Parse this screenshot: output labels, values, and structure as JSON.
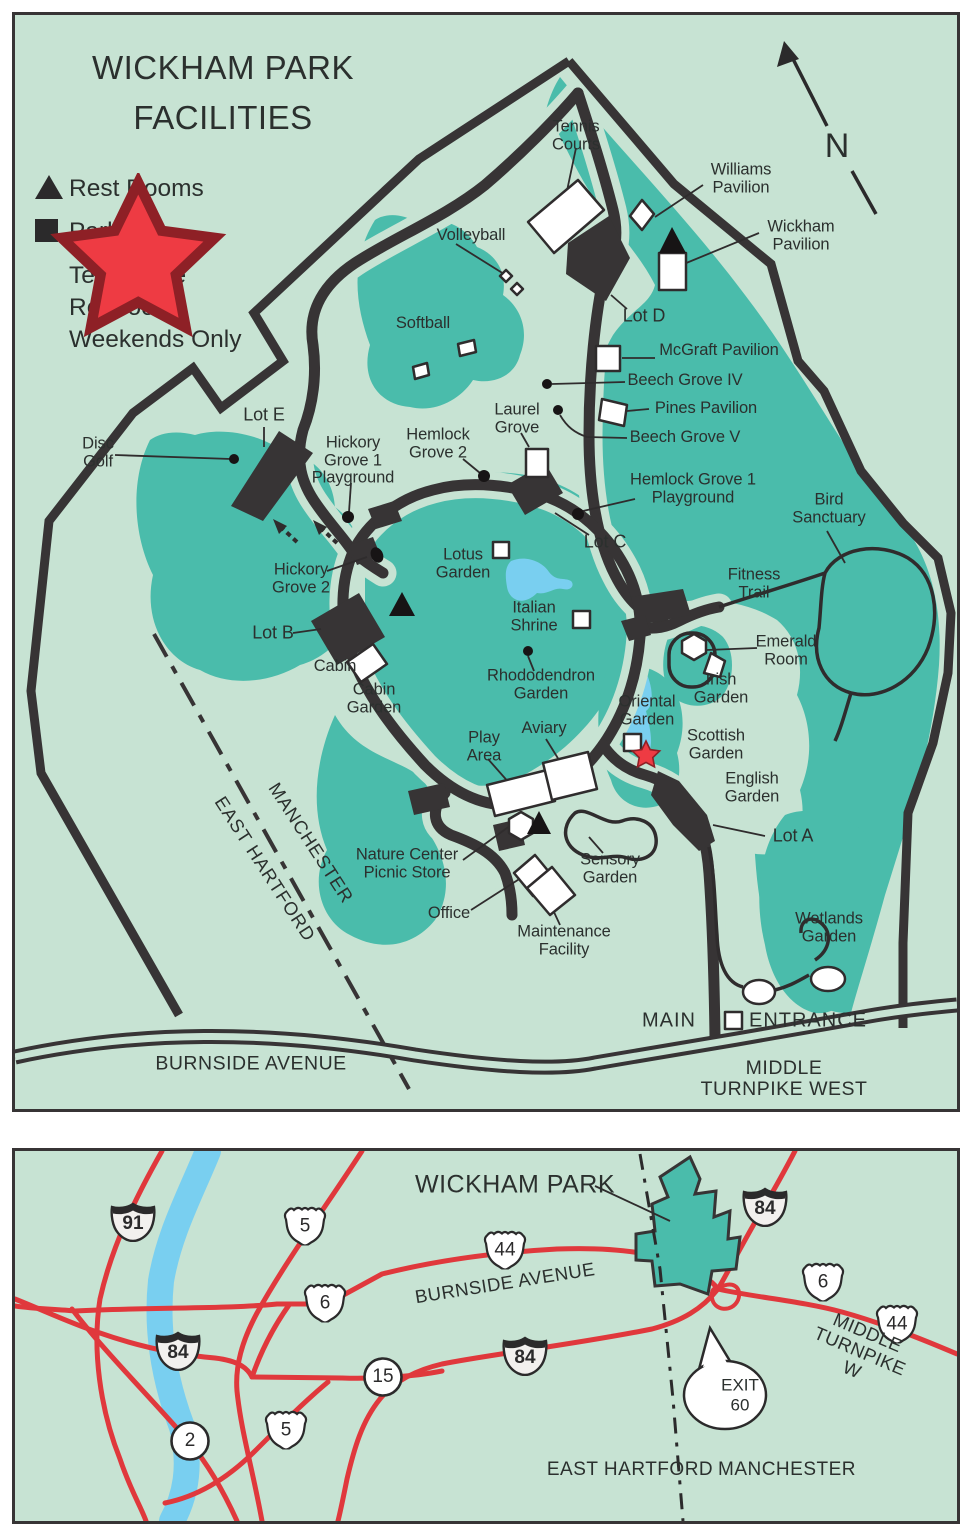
{
  "colors": {
    "background_mint": "#c7e3d3",
    "wooded_teal": "#4abcab",
    "road_dark": "#373435",
    "text_dark": "#2b302e",
    "highway_red": "#e0383c",
    "water_blue": "#79cff0",
    "star_red": "#ee3b43"
  },
  "facilities_map": {
    "title_line1": "WICKHAM PARK",
    "title_line2": "FACILITIES",
    "legend": {
      "restrooms": "Rest Rooms",
      "parking": "Parking",
      "tea_house": "Tea House\nRestroom\nWeekends Only"
    },
    "north_letter": "N",
    "labels": [
      {
        "id": "north-letter",
        "t": "N",
        "x": 822,
        "y": 131,
        "fs": 34
      },
      {
        "id": "tennis-courts",
        "t": "Tennis\nCourts",
        "x": 561,
        "y": 121
      },
      {
        "id": "williams-pavilion",
        "t": "Williams\nPavilion",
        "x": 726,
        "y": 164
      },
      {
        "id": "wickham-pavilion",
        "t": "Wickham\nPavilion",
        "x": 786,
        "y": 221
      },
      {
        "id": "volleyball",
        "t": "Volleyball",
        "x": 456,
        "y": 221
      },
      {
        "id": "softball",
        "t": "Softball",
        "x": 408,
        "y": 309
      },
      {
        "id": "lot-d",
        "t": "Lot D",
        "x": 629,
        "y": 301,
        "fs": 18
      },
      {
        "id": "mcgraft-pavilion",
        "t": "McGraft Pavilion",
        "x": 704,
        "y": 336
      },
      {
        "id": "beech-grove-iv",
        "t": "Beech Grove IV",
        "x": 670,
        "y": 366
      },
      {
        "id": "pines-pavilion",
        "t": "Pines Pavilion",
        "x": 691,
        "y": 394
      },
      {
        "id": "beech-grove-v",
        "t": "Beech Grove V",
        "x": 670,
        "y": 423
      },
      {
        "id": "laurel-grove",
        "t": "Laurel\nGrove",
        "x": 502,
        "y": 404
      },
      {
        "id": "hemlock-grove-2",
        "t": "Hemlock\nGrove 2",
        "x": 423,
        "y": 429
      },
      {
        "id": "hemlock-grove-1-playground",
        "t": "Hemlock Grove 1\nPlayground",
        "x": 678,
        "y": 474
      },
      {
        "id": "lot-c",
        "t": "Lot C",
        "x": 590,
        "y": 527,
        "fs": 18
      },
      {
        "id": "bird-sanctuary",
        "t": "Bird\nSanctuary",
        "x": 814,
        "y": 494
      },
      {
        "id": "lot-e",
        "t": "Lot E",
        "x": 249,
        "y": 400,
        "fs": 18
      },
      {
        "id": "disc-golf",
        "t": "Disc\nGolf",
        "x": 83,
        "y": 438
      },
      {
        "id": "hickory-grove-1-playground",
        "t": "Hickory\nGrove 1\nPlayground",
        "x": 338,
        "y": 446
      },
      {
        "id": "hickory-grove-2",
        "t": "Hickory\nGrove 2",
        "x": 286,
        "y": 564
      },
      {
        "id": "lotus-garden",
        "t": "Lotus\nGarden",
        "x": 448,
        "y": 549
      },
      {
        "id": "fitness-trail",
        "t": "Fitness\nTrail",
        "x": 739,
        "y": 569
      },
      {
        "id": "italian-shrine",
        "t": "Italian\nShrine",
        "x": 519,
        "y": 602
      },
      {
        "id": "emerald-room",
        "t": "Emerald\nRoom",
        "x": 771,
        "y": 636
      },
      {
        "id": "lot-b",
        "t": "Lot B",
        "x": 258,
        "y": 618,
        "fs": 18
      },
      {
        "id": "cabin",
        "t": "Cabin",
        "x": 320,
        "y": 652
      },
      {
        "id": "cabin-garden",
        "t": "Cabin\nGarden",
        "x": 359,
        "y": 684
      },
      {
        "id": "rhododendron-garden",
        "t": "Rhododendron\nGarden",
        "x": 526,
        "y": 670
      },
      {
        "id": "irish-garden",
        "t": "Irish\nGarden",
        "x": 706,
        "y": 674
      },
      {
        "id": "oriental-garden",
        "t": "Oriental\nGarden",
        "x": 632,
        "y": 696
      },
      {
        "id": "scottish-garden",
        "t": "Scottish\nGarden",
        "x": 701,
        "y": 730
      },
      {
        "id": "play-area",
        "t": "Play\nArea",
        "x": 469,
        "y": 732
      },
      {
        "id": "aviary",
        "t": "Aviary",
        "x": 529,
        "y": 714
      },
      {
        "id": "english-garden",
        "t": "English\nGarden",
        "x": 737,
        "y": 773
      },
      {
        "id": "lot-a",
        "t": "Lot A",
        "x": 778,
        "y": 821,
        "fs": 18
      },
      {
        "id": "nature-center-picnic-store",
        "t": "Nature Center\nPicnic Store",
        "x": 392,
        "y": 849
      },
      {
        "id": "sensory-garden",
        "t": "Sensory\nGarden",
        "x": 595,
        "y": 854
      },
      {
        "id": "office",
        "t": "Office",
        "x": 434,
        "y": 899
      },
      {
        "id": "maintenance-facility",
        "t": "Maintenance\nFacility",
        "x": 549,
        "y": 926
      },
      {
        "id": "wetlands-garden",
        "t": "Wetlands\nGarden",
        "x": 814,
        "y": 913
      },
      {
        "id": "main",
        "t": "MAIN",
        "x": 654,
        "y": 1006,
        "fs": 20,
        "ls": 1
      },
      {
        "id": "entrance",
        "t": "ENTRANCE",
        "x": 793,
        "y": 1006,
        "fs": 20,
        "ls": 1
      },
      {
        "id": "manchester",
        "t": "MANCHESTER",
        "x": 296,
        "y": 828,
        "fs": 18.5,
        "rot": 57,
        "ls": 1
      },
      {
        "id": "east-hartford",
        "t": "EAST HARTFORD",
        "x": 250,
        "y": 854,
        "fs": 18.5,
        "rot": 57,
        "ls": 1
      },
      {
        "id": "burnside-avenue",
        "t": "BURNSIDE AVENUE",
        "x": 236,
        "y": 1049,
        "fs": 19.5,
        "ls": 0.5
      },
      {
        "id": "middle-turnpike-west",
        "t": "MIDDLE TURNPIKE WEST",
        "x": 769,
        "y": 1064,
        "fs": 19.5,
        "ls": 0.5
      }
    ]
  },
  "area_map": {
    "labels": [
      {
        "id": "wickham-park",
        "t": "WICKHAM PARK",
        "x": 500,
        "y": 34,
        "fs": 25,
        "ls": 0.5
      },
      {
        "id": "burnside-avenue",
        "t": "BURNSIDE AVENUE",
        "x": 490,
        "y": 132,
        "fs": 18.5,
        "rot": -9,
        "ls": 0.5
      },
      {
        "id": "middle-turnpike-w",
        "t": "MIDDLE TURNPIKE W",
        "x": 845,
        "y": 200,
        "fs": 18.5,
        "rot": 23,
        "ls": 0.5
      },
      {
        "id": "east-hartford",
        "t": "EAST HARTFORD",
        "x": 615,
        "y": 319,
        "fs": 19,
        "ls": 0.5
      },
      {
        "id": "manchester",
        "t": "MANCHESTER",
        "x": 772,
        "y": 319,
        "fs": 19,
        "ls": 0.5
      }
    ],
    "shields": [
      {
        "kind": "interstate",
        "num": "91",
        "x": 118,
        "y": 71
      },
      {
        "kind": "interstate",
        "num": "84",
        "x": 163,
        "y": 200
      },
      {
        "kind": "interstate",
        "num": "84",
        "x": 510,
        "y": 205
      },
      {
        "kind": "interstate",
        "num": "84",
        "x": 750,
        "y": 56
      },
      {
        "kind": "us",
        "num": "5",
        "x": 290,
        "y": 74
      },
      {
        "kind": "us",
        "num": "44",
        "x": 490,
        "y": 98
      },
      {
        "kind": "us",
        "num": "6",
        "x": 310,
        "y": 151
      },
      {
        "kind": "us",
        "num": "5",
        "x": 271,
        "y": 278
      },
      {
        "kind": "us",
        "num": "6",
        "x": 808,
        "y": 130
      },
      {
        "kind": "us",
        "num": "44",
        "x": 882,
        "y": 172
      },
      {
        "kind": "circle",
        "num": "15",
        "x": 368,
        "y": 226
      },
      {
        "kind": "circle",
        "num": "2",
        "x": 175,
        "y": 290
      }
    ],
    "exit": {
      "line1": "EXIT",
      "line2": "60"
    }
  }
}
